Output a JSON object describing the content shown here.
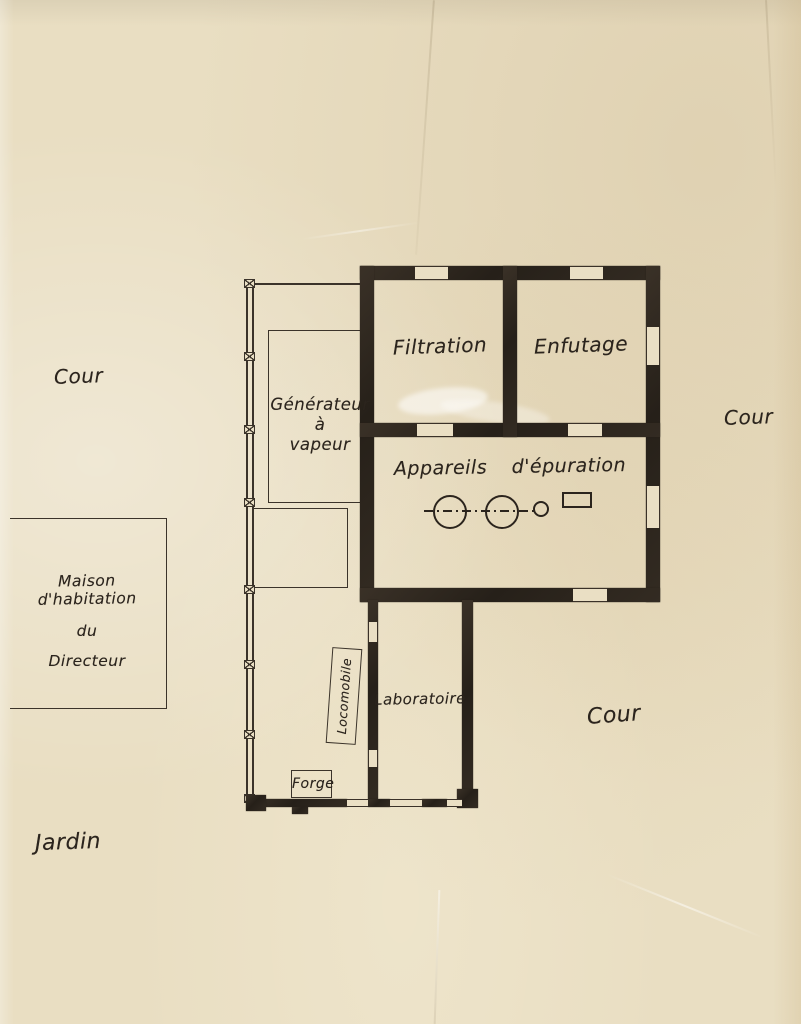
{
  "labels": {
    "cour_left": "Cour",
    "cour_right": "Cour",
    "cour_bottom": "Cour",
    "jardin": "Jardin",
    "maison_line1": "Maison d'habitation",
    "maison_line2": "du",
    "maison_line3": "Directeur",
    "generateur_line1": "Générateur",
    "generateur_line2": "à",
    "generateur_line3": "vapeur",
    "filtration": "Filtration",
    "enfutage": "Enfutage",
    "appareils_word1": "Appareils",
    "appareils_word2": "d'épuration",
    "laboratoire": "Laboratoire",
    "locomobile": "Locomobile",
    "forge": "Forge"
  },
  "colors": {
    "paper": "#e9dec2",
    "ink_thin": "#3b332a",
    "ink_wall": "#2e2720",
    "ink_text": "#2b241d"
  }
}
